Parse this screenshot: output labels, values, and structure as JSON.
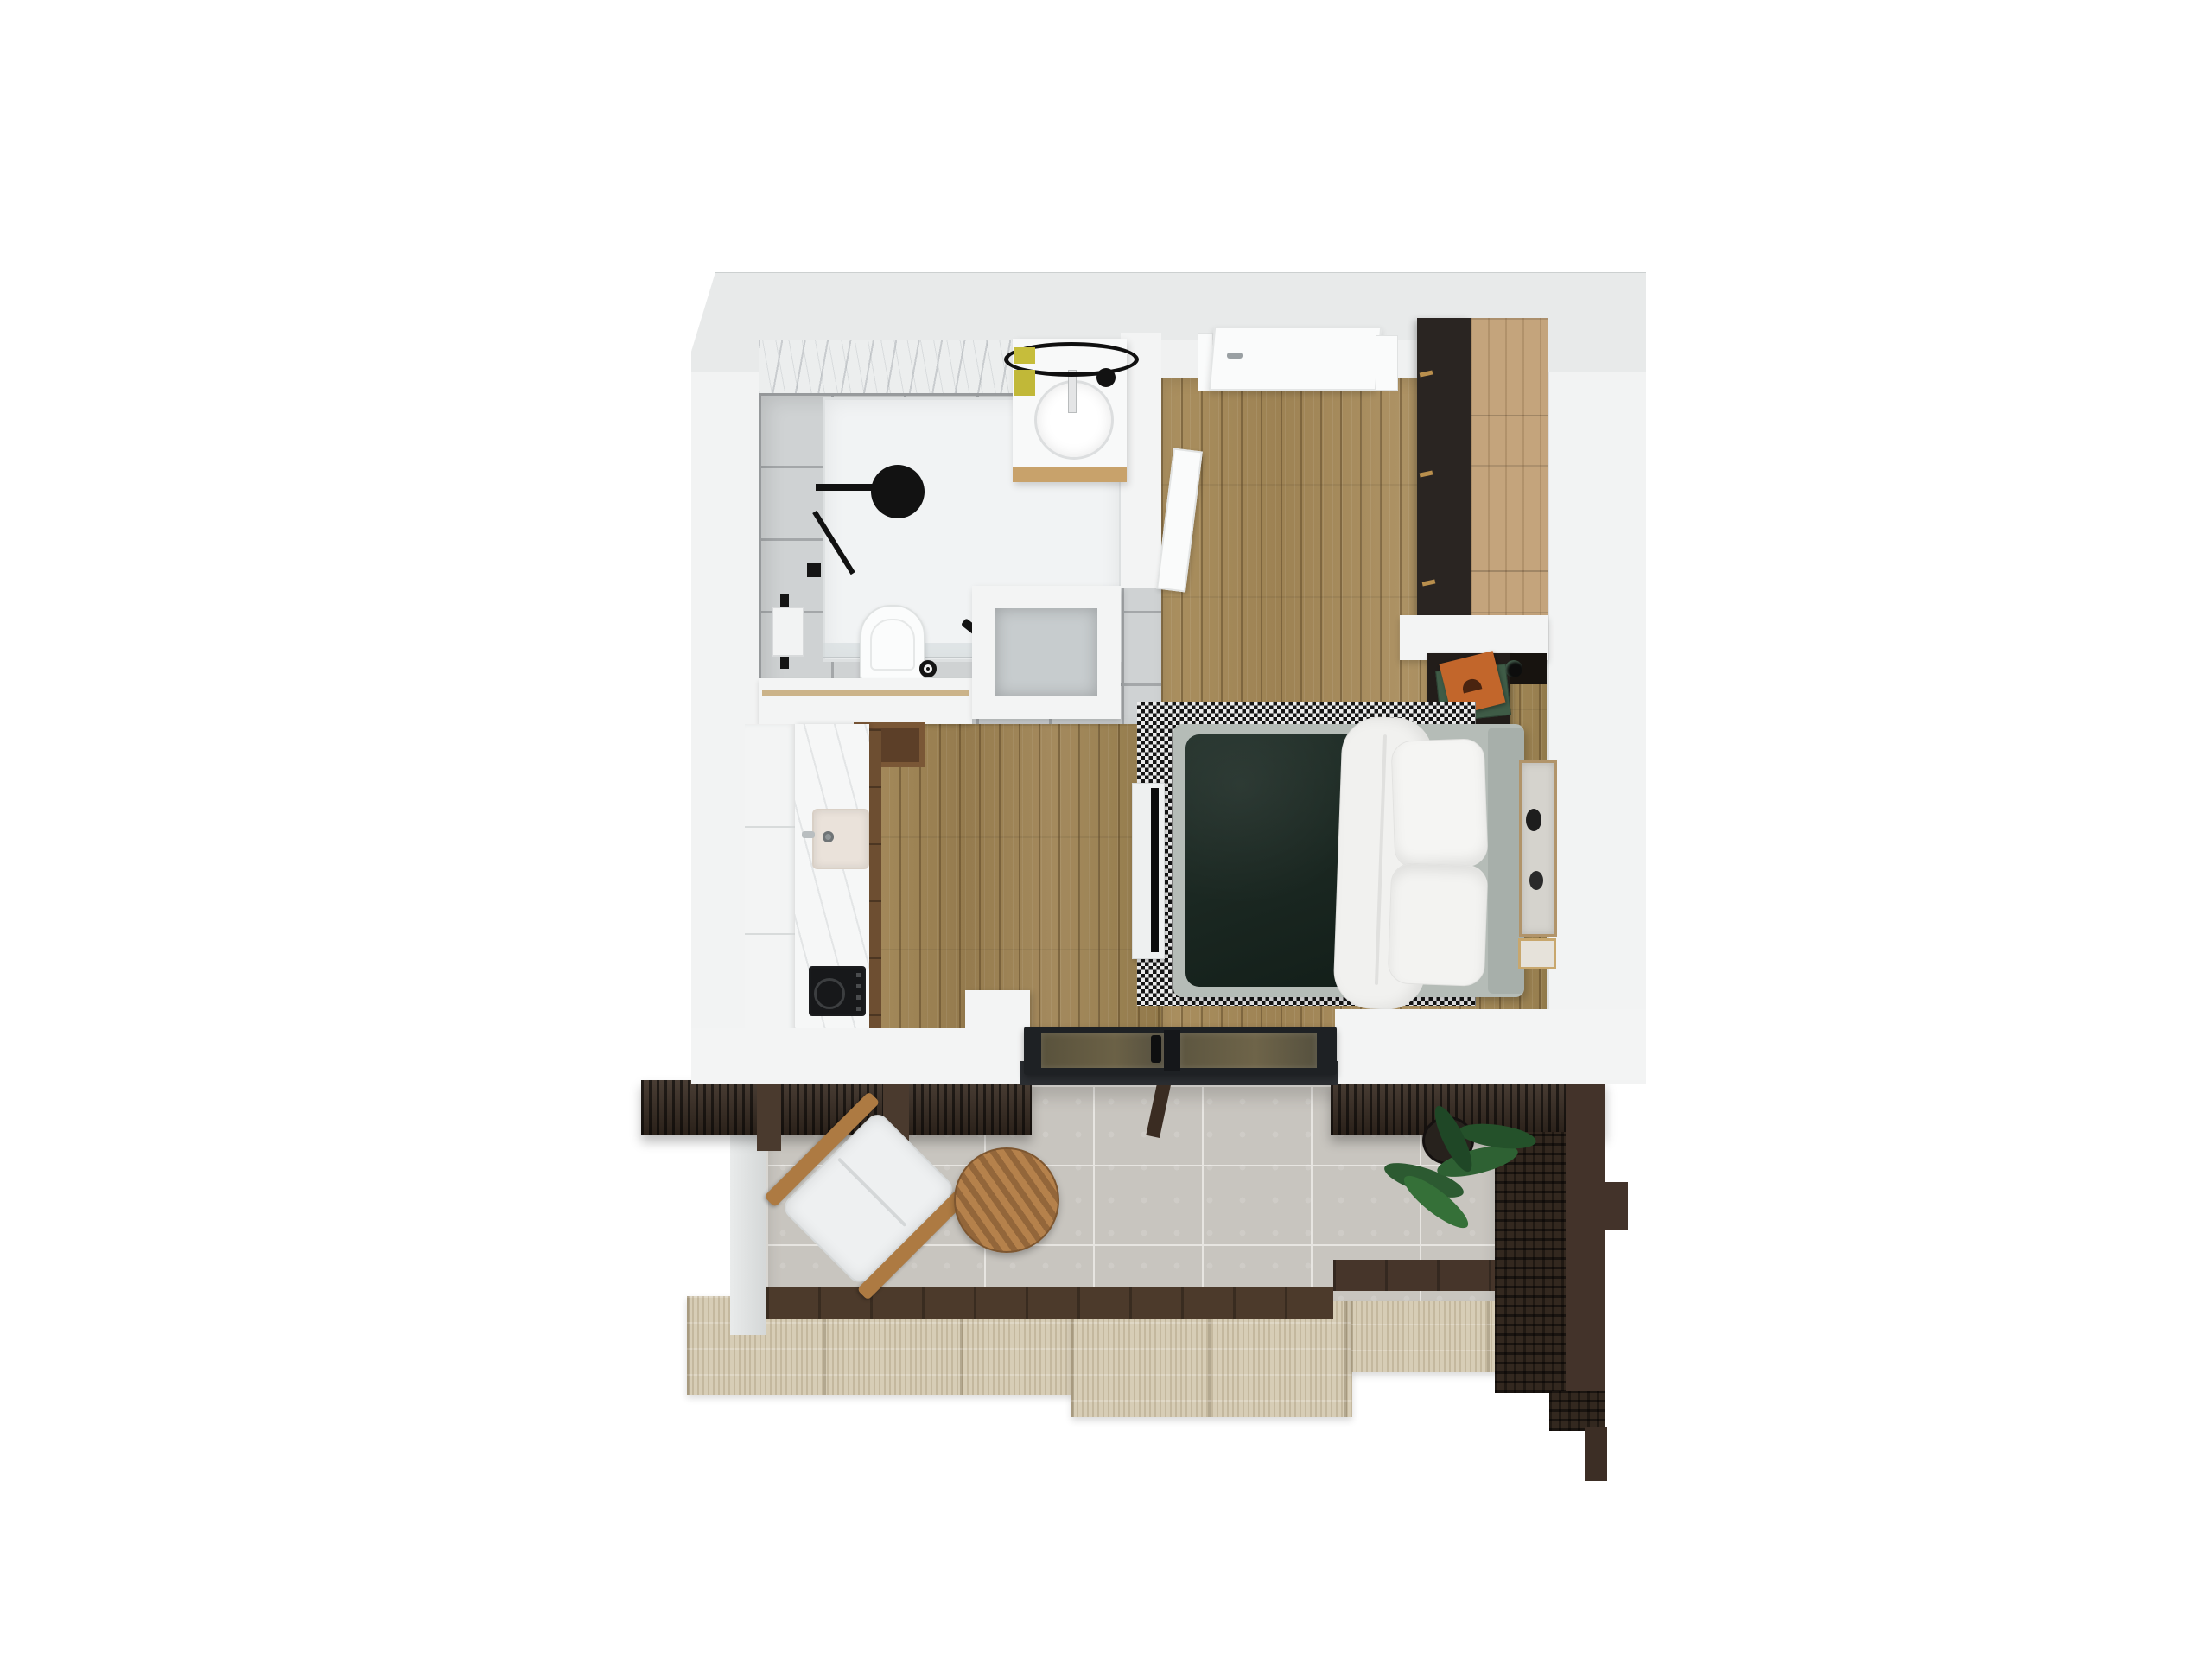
{
  "scene": {
    "title": "Studio apartment – 3D floor plan, top-down render",
    "render_style": "photorealistic top view"
  },
  "palette": {
    "wall_white": "#f3f4f4",
    "roof_band": "#e8eaea",
    "bath_tile": "#cfd2d3",
    "wood_floor": "#a78c5e",
    "wardrobe_dark": "#2a2522",
    "wardrobe_wood": "#c4a47c",
    "bed_duvet_green": "#182720",
    "bed_frame_gray": "#b5bcb7",
    "accent_towel_yellow": "#c6bd3b",
    "book_orange": "#c2662b",
    "pergola_brown": "#3a2d23",
    "balcony_tile": "#c8c5bf",
    "travertine": "#d7cdb6",
    "plant_green": "#2f5c33",
    "glass_frame_black": "#1e2124"
  },
  "rooms": [
    {
      "id": "bathroom",
      "label": "Bathroom",
      "furniture": [
        "corner shower with glass enclosure",
        "black round shower head",
        "black towel rail with white towel",
        "wall-hung toilet",
        "toilet paper holder",
        "vanity with round basin",
        "flat round mirror",
        "yellow towels",
        "black jar"
      ]
    },
    {
      "id": "entry",
      "label": "Entry",
      "furniture": [
        "open entry door",
        "frosted glass niche box"
      ]
    },
    {
      "id": "kitchen",
      "label": "Kitchenette",
      "furniture": [
        "white counter run",
        "inset sink",
        "black induction cooktop",
        "wood cabinet front"
      ]
    },
    {
      "id": "bedroom",
      "label": "Bedroom / living area",
      "furniture": [
        "double bed with dark green duvet",
        "folded white duvet",
        "two white pillows",
        "gray upholstered bed frame",
        "houndstooth rug",
        "TV on white bench",
        "dark wardrobe with gold handles",
        "nightstand with stacked books",
        "black wall lamp",
        "abstract wall art",
        "gold framed picture"
      ]
    },
    {
      "id": "balcony",
      "label": "Balcony",
      "furniture": [
        "black framed sliding glass door",
        "timber pergola slats",
        "timber lattice privacy screen",
        "lounge chair with white cushion",
        "round wooden side table",
        "potted plant",
        "stone tile floor",
        "travertine steps"
      ]
    }
  ]
}
